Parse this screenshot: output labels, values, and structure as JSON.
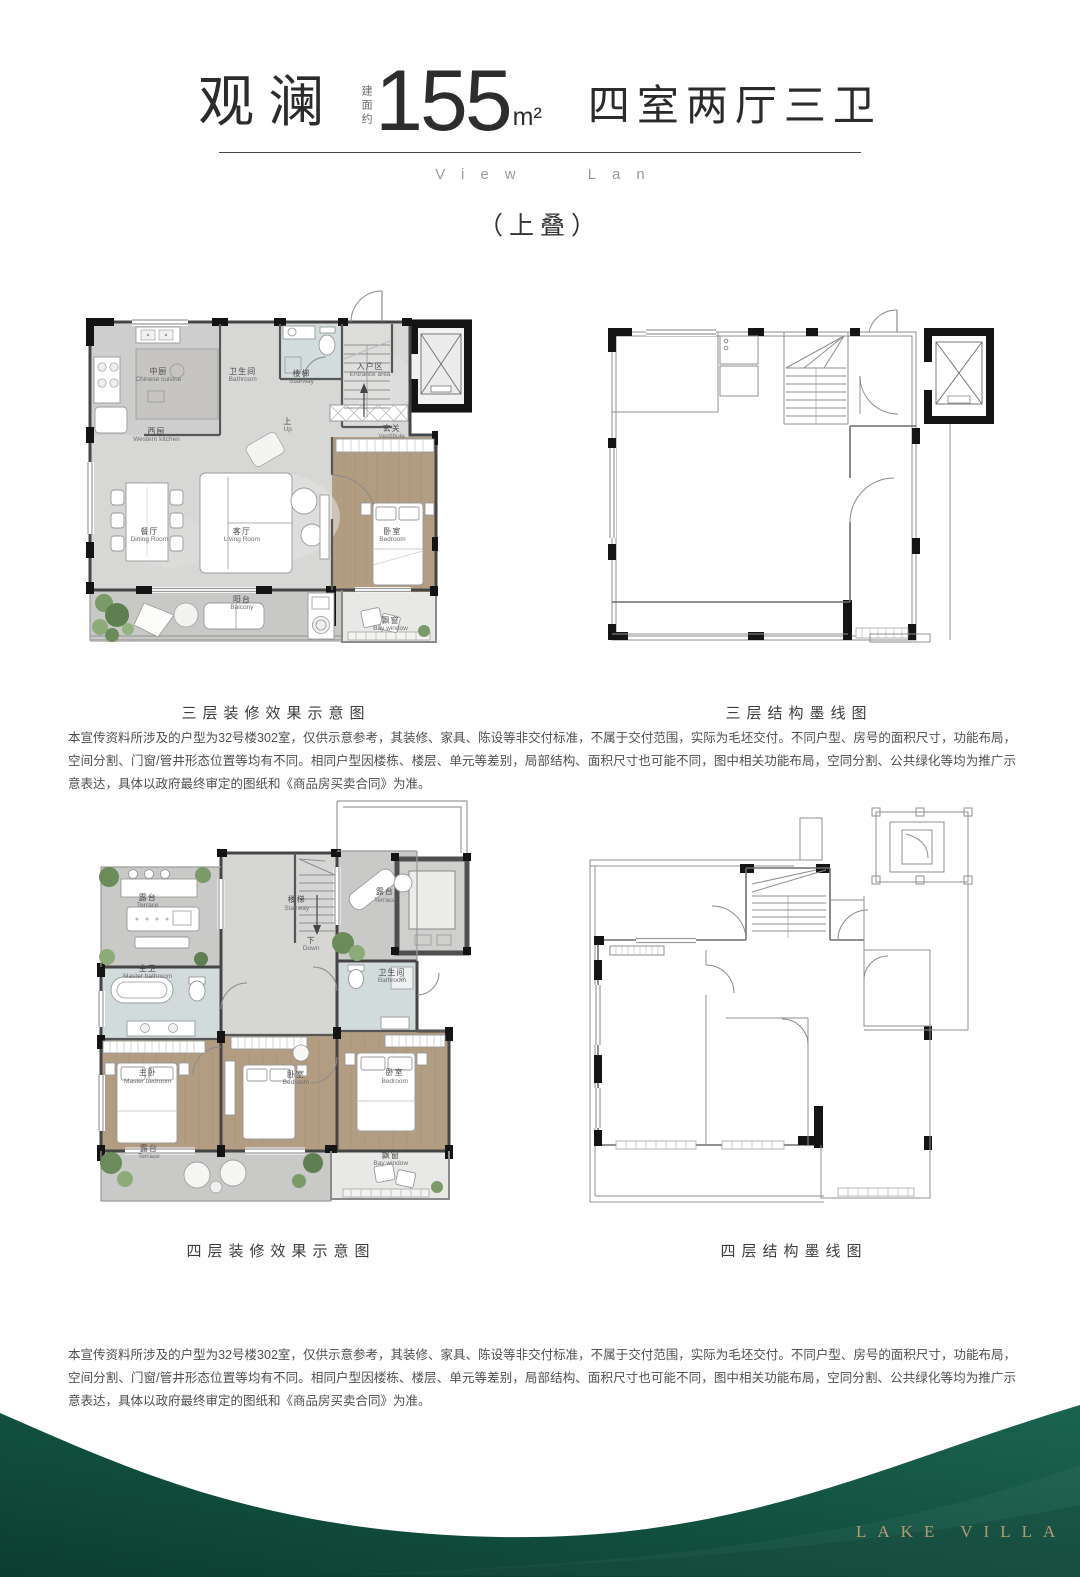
{
  "header": {
    "project_name": "观澜",
    "area_prefix": "建面约",
    "area_value": "155",
    "area_unit": "m²",
    "layout_desc": "四室两厅三卫",
    "subtitle_en": "View Lan",
    "stack_tag": "（上叠）"
  },
  "sections": {
    "floor3": {
      "decorated_caption": "三层装修效果示意图",
      "structural_caption": "三层结构墨线图",
      "disclaimer": "本宣传资料所涉及的户型为32号楼302室，仅供示意参考，其装修、家具、陈设等非交付标准，不属于交付范围，实际为毛坯交付。不同户型、房号的面积尺寸，功能布局，空间分割、门窗/管井形态位置等均有不同。相同户型因楼栋、楼层、单元等差别，局部结构、面积尺寸也可能不同，图中相关功能布局，空同分割、公共绿化等均为推广示意表达，具体以政府最终审定的图纸和《商品房买卖合同》为准。"
    },
    "floor4": {
      "decorated_caption": "四层装修效果示意图",
      "structural_caption": "四层结构墨线图",
      "disclaimer": "本宣传资料所涉及的户型为32号楼302室，仅供示意参考，其装修、家具、陈设等非交付标准，不属于交付范围，实际为毛坯交付。不同户型、房号的面积尺寸，功能布局，空间分割、门窗/管井形态位置等均有不同。相同户型因楼栋、楼层、单元等差别，局部结构、面积尺寸也可能不同，图中相关功能布局，空同分割、公共绿化等均为推广示意表达，具体以政府最终审定的图纸和《商品房买卖合同》为准。"
    }
  },
  "plans": {
    "floor3_decorated": {
      "rooms": [
        {
          "cn": "中厨",
          "en": "Chinese cuisine",
          "x": 20,
          "y": 23.5
        },
        {
          "cn": "卫生间",
          "en": "Bathroom",
          "x": 41.5,
          "y": 23.5
        },
        {
          "cn": "楼梯",
          "en": "Stairway",
          "x": 56.5,
          "y": 24
        },
        {
          "cn": "上",
          "en": "Up",
          "x": 53,
          "y": 36.7
        },
        {
          "cn": "入户区",
          "en": "Entrance area",
          "x": 74,
          "y": 22
        },
        {
          "cn": "玄关",
          "en": "Vestibule",
          "x": 79.5,
          "y": 38.6
        },
        {
          "cn": "西厨",
          "en": "Western kitchen",
          "x": 19.5,
          "y": 39.4
        },
        {
          "cn": "餐厅",
          "en": "Dining Room",
          "x": 17.7,
          "y": 66
        },
        {
          "cn": "客厅",
          "en": "Living Room",
          "x": 41.3,
          "y": 66
        },
        {
          "cn": "卧室",
          "en": "Bedroom",
          "x": 79.7,
          "y": 66.2
        },
        {
          "cn": "阳台",
          "en": "Balcony",
          "x": 41.3,
          "y": 84.2
        },
        {
          "cn": "飘窗",
          "en": "Bay window",
          "x": 79.2,
          "y": 89.8
        }
      ]
    },
    "floor4_decorated": {
      "rooms": [
        {
          "cn": "露台",
          "en": "Terrace",
          "x": 16,
          "y": 25
        },
        {
          "cn": "楼梯",
          "en": "Stairway",
          "x": 54,
          "y": 25.7
        },
        {
          "cn": "下",
          "en": "Down",
          "x": 57.7,
          "y": 35.2
        },
        {
          "cn": "露台",
          "en": "Terrace",
          "x": 76.5,
          "y": 23.8
        },
        {
          "cn": "主卫",
          "en": "Master bathroom",
          "x": 16,
          "y": 41.9
        },
        {
          "cn": "卫生间",
          "en": "Bathroom",
          "x": 78.3,
          "y": 42.9
        },
        {
          "cn": "主卧",
          "en": "Master bedroom",
          "x": 16,
          "y": 66.7
        },
        {
          "cn": "卧室",
          "en": "Bedroom",
          "x": 53.8,
          "y": 67.1
        },
        {
          "cn": "卧室",
          "en": "Bedroom",
          "x": 79,
          "y": 66.7
        },
        {
          "cn": "露台",
          "en": "Terrace",
          "x": 16.3,
          "y": 84.5
        },
        {
          "cn": "飘窗",
          "en": "Bay window",
          "x": 78,
          "y": 86.2
        }
      ]
    }
  },
  "footer": {
    "brand": "LAKE VILLA",
    "wave_color": "#0e4837",
    "brand_color": "#b49a73"
  }
}
